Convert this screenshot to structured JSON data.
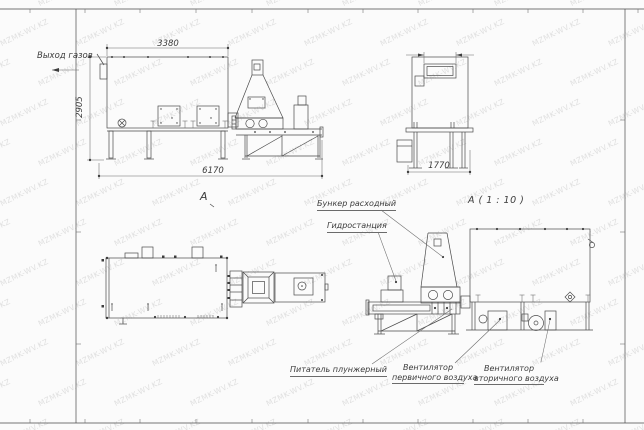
{
  "watermark": {
    "text": "MZMK-WV.KZ"
  },
  "labels": {
    "gas_outlet": "Выход газов",
    "view_mark": "A",
    "detail_title": "А ( 1 : 10 )",
    "feed_hopper": "Бункер расходный",
    "hydrostation": "Гидростанция",
    "plunger_feeder": "Питатель плунжерный",
    "primary_fan_line1": "Вентилятор",
    "primary_fan_line2": "первичного воздуха",
    "secondary_fan_line1": "Вентилятор",
    "secondary_fan_line2": "вторичного воздуха"
  },
  "dimensions": {
    "furnace_width": "3380",
    "furnace_height": "2905",
    "overall_length": "6170",
    "side_width": "1770"
  },
  "colors": {
    "line": "#4a4a4a",
    "text": "#3c3c3c",
    "background": "#fbfbfb",
    "watermark": "#bdbdbd"
  }
}
